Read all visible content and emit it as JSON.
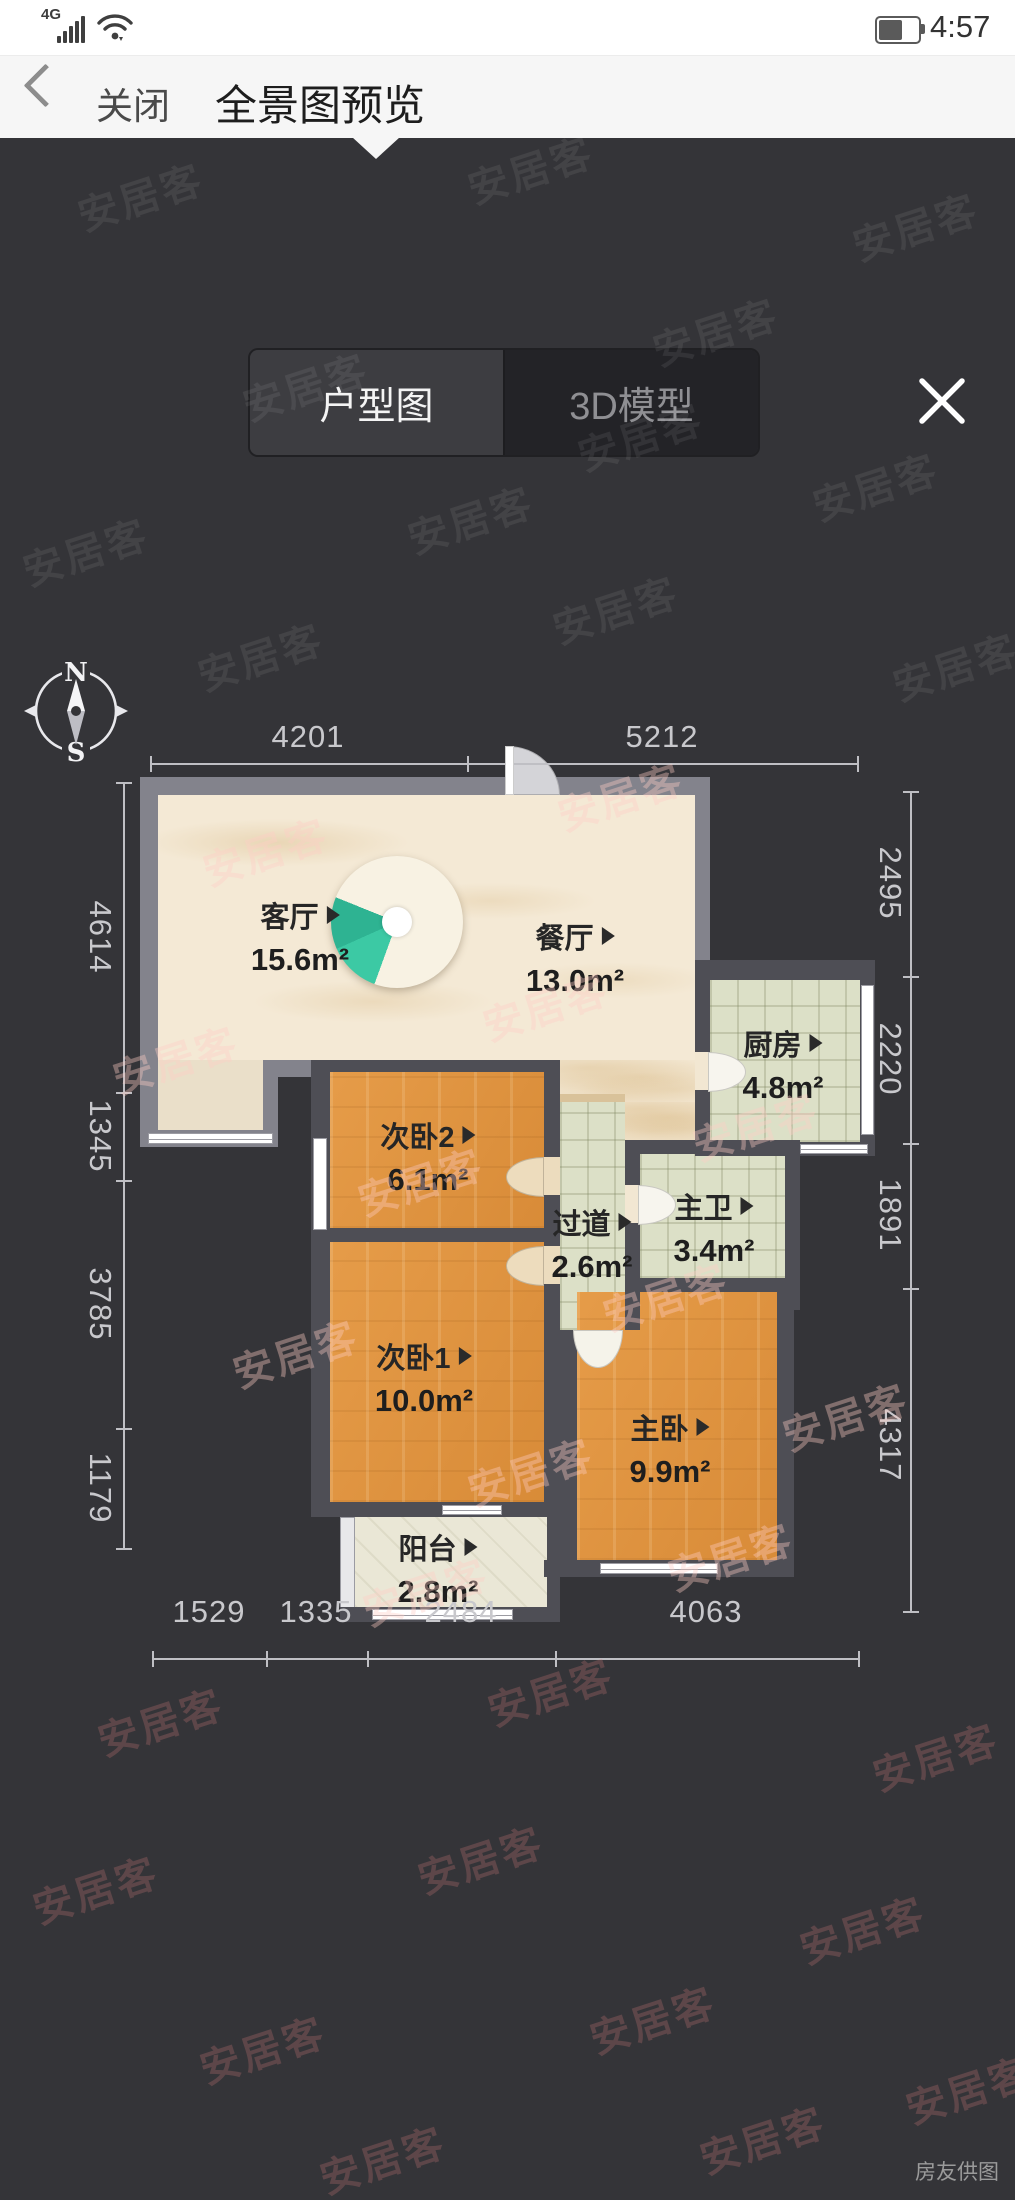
{
  "status_bar": {
    "network": "4G",
    "time": "4:57"
  },
  "header": {
    "back_label": "关闭",
    "title": "全景图预览"
  },
  "tabs": {
    "floor_plan_label": "户型图",
    "model_3d_label": "3D模型"
  },
  "compass": {
    "north": "N",
    "south": "S"
  },
  "floor_plan": {
    "rooms": [
      {
        "id": "living",
        "name": "客厅",
        "area": "15.6m²"
      },
      {
        "id": "dining",
        "name": "餐厅",
        "area": "13.0m²"
      },
      {
        "id": "kitchen",
        "name": "厨房",
        "area": "4.8m²"
      },
      {
        "id": "bedroom2",
        "name": "次卧2",
        "area": "6.1m²"
      },
      {
        "id": "hallway",
        "name": "过道",
        "area": "2.6m²"
      },
      {
        "id": "master-bath",
        "name": "主卫",
        "area": "3.4m²"
      },
      {
        "id": "bedroom1",
        "name": "次卧1",
        "area": "10.0m²"
      },
      {
        "id": "master-bedroom",
        "name": "主卧",
        "area": "9.9m²"
      },
      {
        "id": "balcony",
        "name": "阳台",
        "area": "2.8m²"
      }
    ],
    "dimensions": {
      "top": [
        "4201",
        "5212"
      ],
      "left": [
        "4614",
        "1345",
        "3785",
        "1179"
      ],
      "right": [
        "2495",
        "2220",
        "1891",
        "4317"
      ],
      "bottom": [
        "1529",
        "1335",
        "2484",
        "4063"
      ]
    }
  },
  "watermark": "安居客",
  "credit": "房友供图",
  "colors": {
    "background": "#343438",
    "header_bg": "#f6f6f6",
    "wall_outer": "#83838c",
    "wall_inner": "#4e4e55",
    "floor_cream": "#f4e9d5",
    "floor_wood": "#e0923c",
    "floor_tile": "#dce0c7",
    "accent_teal": "#3cc9a4",
    "dim_text": "#c8c8cc",
    "active_tab_text": "#f4f4f4",
    "inactive_tab_text": "#8f8f93"
  }
}
